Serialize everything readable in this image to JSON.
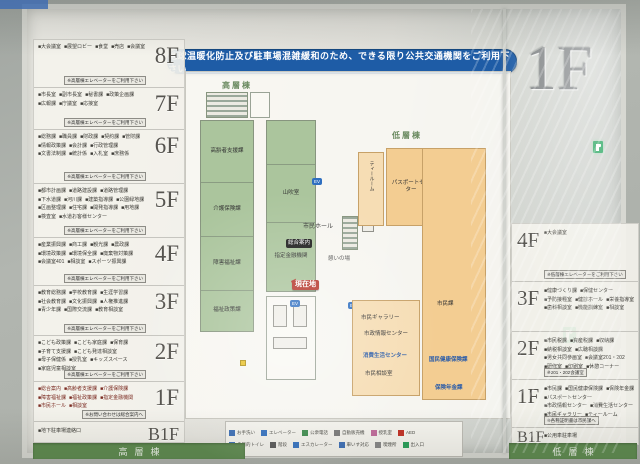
{
  "ui": {
    "bullet": "■"
  },
  "banner": {
    "text": "地球温暖化防止及び駐車場混雑緩和のため、できる限り公共交通機関をご利用下さい"
  },
  "glass": {
    "floor_label": "1F"
  },
  "wings": {
    "left_bar": "高層棟",
    "right_bar": "低層棟"
  },
  "colors": {
    "banner_blue": "#1e5ca6",
    "highrise_green": "#abc59d",
    "lowrise_orange": "#f3cd92",
    "wing_bar_green": "#5d8a4f",
    "current_badge_red": "#b5342a"
  },
  "left_panel": {
    "wing": "高層棟",
    "floors": [
      {
        "label": "8F",
        "items": [
          "大会議室",
          "展望ロビー",
          "食堂",
          "売店",
          "会議室"
        ],
        "note": "※高層棟エレベーターをご利用下さい"
      },
      {
        "label": "7F",
        "items": [
          "市長室",
          "副市長室",
          "秘書課",
          "政策企画課",
          "広報課",
          "庁議室",
          "応接室"
        ],
        "note": "※高層棟エレベーターをご利用下さい"
      },
      {
        "label": "6F",
        "items": [
          "総務課",
          "職員課",
          "財政課",
          "契約課",
          "管財課",
          "情報政策課",
          "会計課",
          "行政管理課",
          "文書法制課",
          "統計係",
          "入札室",
          "庶務係"
        ],
        "note": "※高層棟エレベーターをご利用下さい"
      },
      {
        "label": "5F",
        "items": [
          "都市計画課",
          "道路建設課",
          "道路管理課",
          "下水道課",
          "河川課",
          "建築指導課",
          "公園緑地課",
          "区画整理課",
          "住宅課",
          "開発指導課",
          "用地課",
          "検査室",
          "水道お客様センター"
        ],
        "note": "※高層棟エレベーターをご利用下さい"
      },
      {
        "label": "4F",
        "items": [
          "産業振興課",
          "商工課",
          "観光課",
          "農政課",
          "環境政策課",
          "環境保全課",
          "廃棄物対策課",
          "会議室401",
          "相談室",
          "スポーツ振興課"
        ],
        "note": "※高層棟エレベーターをご利用下さい"
      },
      {
        "label": "3F",
        "items": [
          "教育総務課",
          "学校教育課",
          "生涯学習課",
          "社会教育課",
          "文化振興課",
          "人権推進課",
          "青少年課",
          "国際交流課",
          "教育相談室"
        ],
        "note": "※高層棟エレベーターをご利用下さい"
      },
      {
        "label": "2F",
        "items": [
          "こども政策課",
          "こども家庭課",
          "保育課",
          "子育て支援課",
          "こども発達相談室",
          "母子保健係",
          "授乳室",
          "キッズスペース",
          "家庭児童相談室"
        ],
        "note": "※高層棟エレベーターをご利用下さい"
      },
      {
        "label": "1F",
        "items": [
          "総合案内",
          "高齢者支援課",
          "介護保険課",
          "障害福祉課",
          "福祉政策課",
          "指定金融機関",
          "市民ホール",
          "相談室"
        ],
        "item_color": "#7a2a20",
        "note": "※お問い合わせは総合案内へ"
      },
      {
        "label": "B1F",
        "items": [
          "地下駐車場連絡口"
        ]
      }
    ]
  },
  "right_panel": {
    "wing": "低層棟",
    "floors": [
      {
        "label": "4F",
        "items": [
          "大会議室"
        ],
        "note": "※低層棟エレベーターをご利用下さい"
      },
      {
        "label": "3F",
        "items": [
          "健康づくり課",
          "保健センター",
          "予防接種室",
          "健診ホール",
          "栄養指導室",
          "歯科相談室",
          "機能訓練室",
          "相談室"
        ]
      },
      {
        "label": "2F",
        "items": [
          "市民税課",
          "資産税課",
          "収納課",
          "納税相談室",
          "広聴相談課",
          "男女共同参画室",
          "会議室201・202",
          "研修室",
          "印刷室",
          "休憩コーナー"
        ],
        "note": "※201・202会議室"
      },
      {
        "label": "1F",
        "items": [
          "市民課",
          "国民健康保険課",
          "保険年金課",
          "パスポートセンター",
          "市政情報センター",
          "消費生活センター",
          "市民ギャラリー",
          "ティールーム"
        ],
        "note": "※各種証明書は市民課へ"
      },
      {
        "label": "B1F",
        "items": [
          "公用車駐車場"
        ]
      }
    ]
  },
  "map": {
    "highrise_title": "高層棟",
    "lowrise_title": "低層棟",
    "rooms": {
      "kourei": "高齢者支援課",
      "kaigo": "介護保険課",
      "shougai": "障害福祉課",
      "fukushi": "福祉政策課",
      "yamabuki": "山吹室",
      "kinyu": "指定金融機関",
      "hall": "市民ホール",
      "ikoi": "憩いの場",
      "tearoom": "ティールーム",
      "passport": "パスポートセンター",
      "shiminka": "市民課",
      "kokuho": "国民健康保険課",
      "nenkin": "保険年金課",
      "shohi": "消費生活センター",
      "gallery": "市民ギャラリー",
      "joho": "市政情報センター",
      "soudan": "市民相談室"
    },
    "badges": {
      "current_location": "現在地",
      "information": "総合案内",
      "elevator": "EV"
    }
  },
  "legend": {
    "row1": [
      {
        "label": "お手洗い",
        "color": "#3a6db5"
      },
      {
        "label": "エレベーター",
        "color": "#2f6fc0"
      },
      {
        "label": "公衆電話",
        "color": "#3a8a4a"
      },
      {
        "label": "自動販売機",
        "color": "#777777"
      },
      {
        "label": "授乳室",
        "color": "#c06a9a"
      },
      {
        "label": "AED",
        "color": "#c33327"
      }
    ],
    "row2": [
      {
        "label": "多目的トイレ",
        "color": "#3a6db5"
      },
      {
        "label": "階段",
        "color": "#555555"
      },
      {
        "label": "エスカレーター",
        "color": "#2f6fc0"
      },
      {
        "label": "車いす対応",
        "color": "#3a6db5"
      },
      {
        "label": "喫煙所",
        "color": "#888888"
      },
      {
        "label": "出入口",
        "color": "#2aa05a"
      }
    ]
  }
}
